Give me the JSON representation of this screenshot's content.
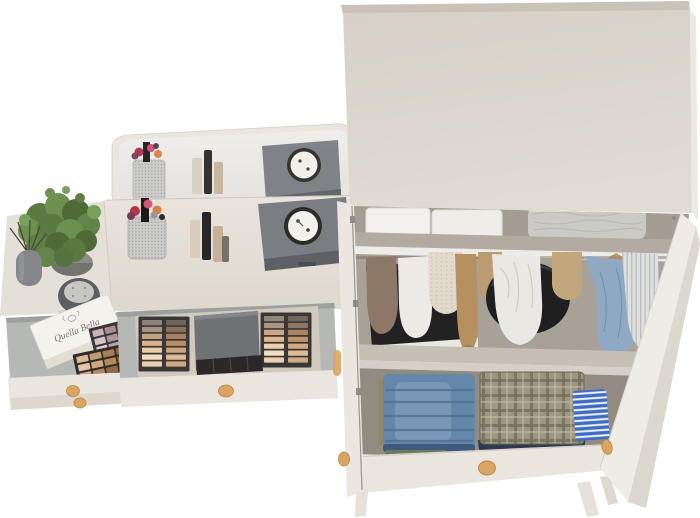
{
  "image": {
    "background": "#ffffff"
  },
  "colors": {
    "background": "#ffffff",
    "cream": "#eae5de",
    "cream_shadow": "#ddd7ce",
    "panel": "#d9d3cb",
    "panel_edge": "#c8c2b8",
    "drawer_gray": "#b6b8b6",
    "interior_back": "#a49d94",
    "interior_floor": "#918b82",
    "shelf_top": "#b2aba2",
    "shelf_face": "#eeece7",
    "case_gray": "#7a7e82",
    "case_front": "#5d6064",
    "clock_face": "#f2f0ea",
    "clock_ring": "#2c2b29",
    "knob_wood": "#d9a561",
    "denim": "#6487aa",
    "denim_dark": "#49688e",
    "plaid": "#9d9681",
    "stripe_blue": "#3f6cc0",
    "shirt_blue": "#8fa9c3",
    "duffel_black": "#1f1f1f",
    "bin_white": "#f1f0ed",
    "basket_gray": "#cbc9c5",
    "plant_green": "#5f8045",
    "pot_gray": "#8b8b86",
    "mirror_gray": "#6f7275",
    "kit_base": "#d0c9bc",
    "palette_frame": "#3a3837",
    "box_white": "#f4f2ed",
    "navy": "#2e3850"
  },
  "vanity": {
    "box_label": "Quella Bella",
    "desktop_items": [
      "potted-plant",
      "reed-diffuser",
      "round-speaker",
      "brush-cup",
      "cosmetics",
      "gray-case-with-clock"
    ],
    "drawer_items": [
      "gift-box",
      "eyeshadow-palette-mauve",
      "eyeshadow-palette-nude",
      "makeup-kit-with-mirror"
    ],
    "palette_small_mauve": [
      "#c9b2b8",
      "#a98c95",
      "#8a6b76",
      "#6b4c58",
      "#d8c2c6",
      "#b1949c",
      "#93737e",
      "#745560",
      "#e2d0d3",
      "#bda3aa",
      "#9f7f8a",
      "#815f6c"
    ],
    "palette_small_nude": [
      "#d9b893",
      "#c09a6f",
      "#a87e53",
      "#8a6440",
      "#e3c6a4",
      "#cfa87e",
      "#b58a58",
      "#976e46",
      "#caa87f",
      "#b08a5c",
      "#8f6a42",
      "#6f4f30"
    ],
    "kit_left_shades": [
      "#8f8478",
      "#6f6459",
      "#a99181",
      "#8a7260",
      "#c5a284",
      "#a87f5f",
      "#dab28b",
      "#bb8e67",
      "#e9cba6",
      "#cda57c",
      "#f1dbbf",
      "#ddb991",
      "#e7cfb2",
      "#cbaa84"
    ],
    "kit_right_shades": [
      "#93867a",
      "#73665b",
      "#ad9584",
      "#8e7664",
      "#c9a688",
      "#ac8363",
      "#deb68f",
      "#bf926b",
      "#edcfaa",
      "#d1a980",
      "#f3ddc1",
      "#dfbb93",
      "#e9d1b4",
      "#cdac86"
    ]
  },
  "wardrobe": {
    "top_shelf_items": [
      "storage-bin",
      "storage-bin",
      "fabric-basket"
    ],
    "hanging_items": [
      "suitcase",
      "brown-garment",
      "cream-knit",
      "dotted-knit",
      "camel-sweater",
      "tan-garment",
      "duffel-bag",
      "white-garment",
      "beige-garment",
      "blue-shirt",
      "striped-shirt"
    ],
    "lower_shelf_items": [
      "folded-jeans",
      "folded-plaid-shirts",
      "striped-blue-fabric",
      "navy-folded-garments"
    ]
  }
}
